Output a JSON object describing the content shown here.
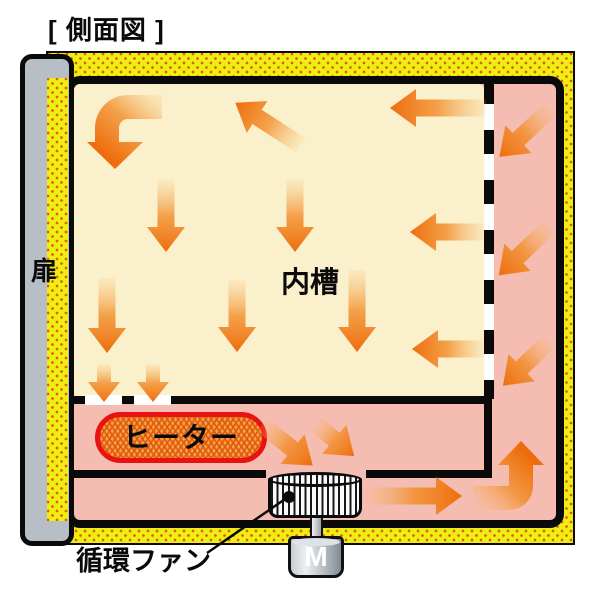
{
  "title": "[ 側面図 ]",
  "diagram": {
    "door": {
      "label": "扉"
    },
    "inner_chamber": {
      "label": "内槽"
    },
    "heater": {
      "label": "ヒーター"
    },
    "circulation_fan": {
      "label": "循環ファン"
    },
    "motor": {
      "label": "M"
    }
  },
  "colors": {
    "insulation_yellow": "#EEEE12",
    "insulation_dot": "#E05A10",
    "door_gray": "#B7BEC6",
    "chamber_cream": "#FAF0CC",
    "plenum_pink": "#F5BCB1",
    "arrow_orange": "#ED6D0C",
    "heater_fill": "#F9A030",
    "heater_border": "#E91212",
    "outline": "#0A0A0A"
  }
}
